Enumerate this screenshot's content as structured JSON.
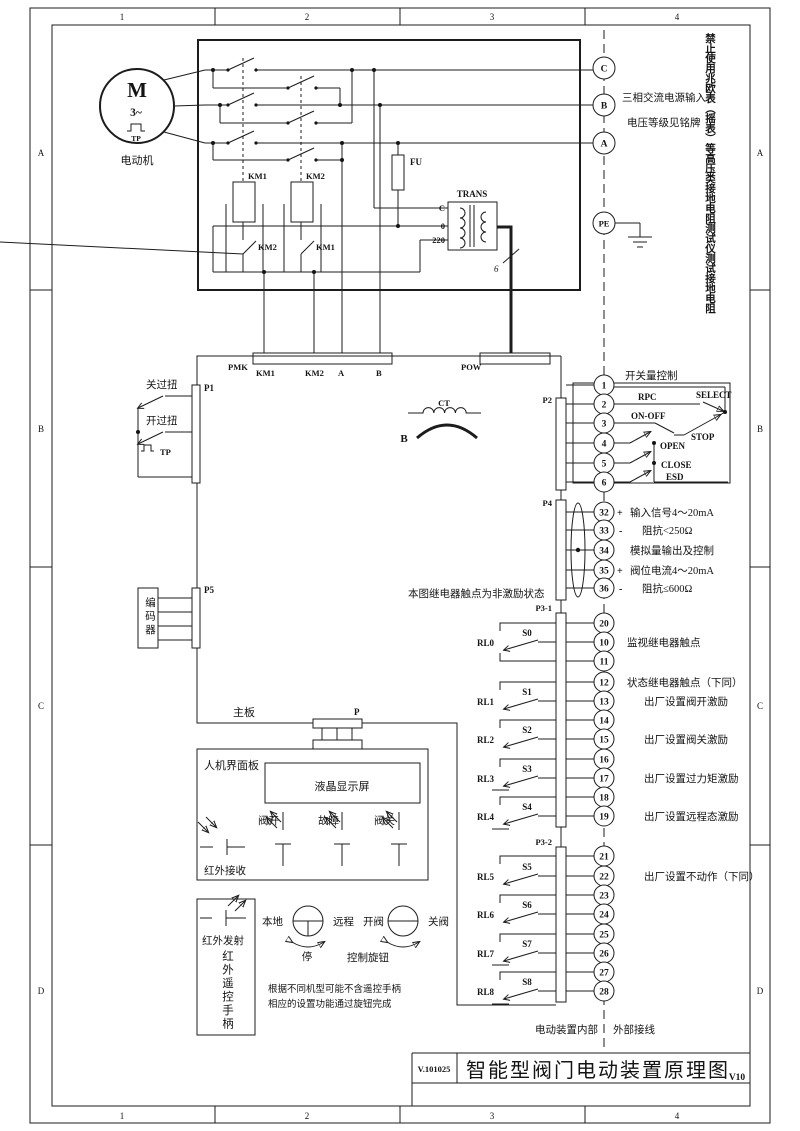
{
  "frame": {
    "cols": [
      "1",
      "2",
      "3",
      "4"
    ],
    "rows": [
      "A",
      "B",
      "C",
      "D"
    ]
  },
  "warning_vertical": "禁止使用兆欧表（摇表）等高压类接地电阻测试仪测试接地电阻",
  "power": {
    "motor_m": "M",
    "motor_phase": "3~",
    "motor_tp": "TP",
    "motor_label": "电动机",
    "km1": "KM1",
    "km2": "KM2",
    "km1_aux": "KM2",
    "km2_aux": "KM1",
    "fu": "FU",
    "trans": "TRANS",
    "tap_c": "C",
    "tap_0": "0",
    "tap_220": "220",
    "wire_count": "6",
    "t_c": "C",
    "t_b": "B",
    "t_a": "A",
    "t_pe": "PE",
    "supply_line1": "三相交流电源输入",
    "supply_line2": "电压等级见铭牌"
  },
  "pmk": {
    "label": "PMK",
    "pin1": "KM1",
    "pin2": "KM2",
    "pin3": "A",
    "pin4": "B"
  },
  "pow_label": "POW",
  "p1": {
    "label": "P1",
    "sw1": "关过扭",
    "sw2": "开过扭",
    "sw3": "TP"
  },
  "ct": {
    "label": "CT",
    "b": "B"
  },
  "p5": {
    "label": "P5",
    "encoder": "编码器"
  },
  "p2": {
    "label": "P2",
    "title": "开关量控制",
    "terminals": [
      "1",
      "2",
      "3",
      "4",
      "5",
      "6"
    ],
    "rpc": "RPC",
    "select": "SELECT",
    "onoff": "ON-OFF",
    "stop": "STOP",
    "open": "OPEN",
    "close": "CLOSE",
    "esd": "ESD"
  },
  "p4": {
    "label": "P4",
    "terminals": [
      "32",
      "33",
      "34",
      "35",
      "36"
    ],
    "plus": "+",
    "minus": "-",
    "l1": "输入信号4～20mA",
    "l2": "阻抗<250Ω",
    "l3": "模拟量输出及控制",
    "l4": "阀位电流4～20mA",
    "l5": "阻抗≤600Ω"
  },
  "relay_note": "本图继电器触点为非激励状态",
  "p31": {
    "label": "P3-1",
    "terminals": [
      "20",
      "10",
      "11",
      "12",
      "13",
      "14",
      "15",
      "16",
      "17",
      "18",
      "19"
    ],
    "rl0": "RL0",
    "rl1": "RL1",
    "rl2": "RL2",
    "rl3": "RL3",
    "rl4": "RL4",
    "s0": "S0",
    "s1": "S1",
    "s2": "S2",
    "s3": "S3",
    "s4": "S4",
    "d1": "监视继电器触点",
    "d2": "状态继电器触点（下同）",
    "d3": "出厂设置阀开激励",
    "d4": "出厂设置阀关激励",
    "d5": "出厂设置过力矩激励",
    "d6": "出厂设置远程态激励"
  },
  "p32": {
    "label": "P3-2",
    "terminals": [
      "21",
      "22",
      "23",
      "24",
      "25",
      "26",
      "27",
      "28"
    ],
    "rl5": "RL5",
    "rl6": "RL6",
    "rl7": "RL7",
    "rl8": "RL8",
    "s5": "S5",
    "s6": "S6",
    "s7": "S7",
    "s8": "S8",
    "d1": "出厂设置不动作（下同）"
  },
  "board": {
    "main": "主板",
    "p": "P",
    "hmi": "人机界面板",
    "lcd": "液晶显示屏",
    "ir_rx": "红外接收",
    "led1": "阀开",
    "led2": "故障",
    "led3": "阀关",
    "ir_tx": "红外发射",
    "remote_handle": "红外遥控手柄",
    "local": "本地",
    "remote": "远程",
    "stop": "停",
    "knob": "控制旋钮",
    "open": "开阀",
    "close": "关阀",
    "note1": "根据不同机型可能不含遥控手柄",
    "note2": "相应的设置功能通过旋钮完成"
  },
  "footer": {
    "internal": "电动装置内部",
    "external": "外部接线"
  },
  "title_block": {
    "code": "V.101025",
    "title": "智能型阀门电动装置原理图",
    "version": "V10"
  }
}
